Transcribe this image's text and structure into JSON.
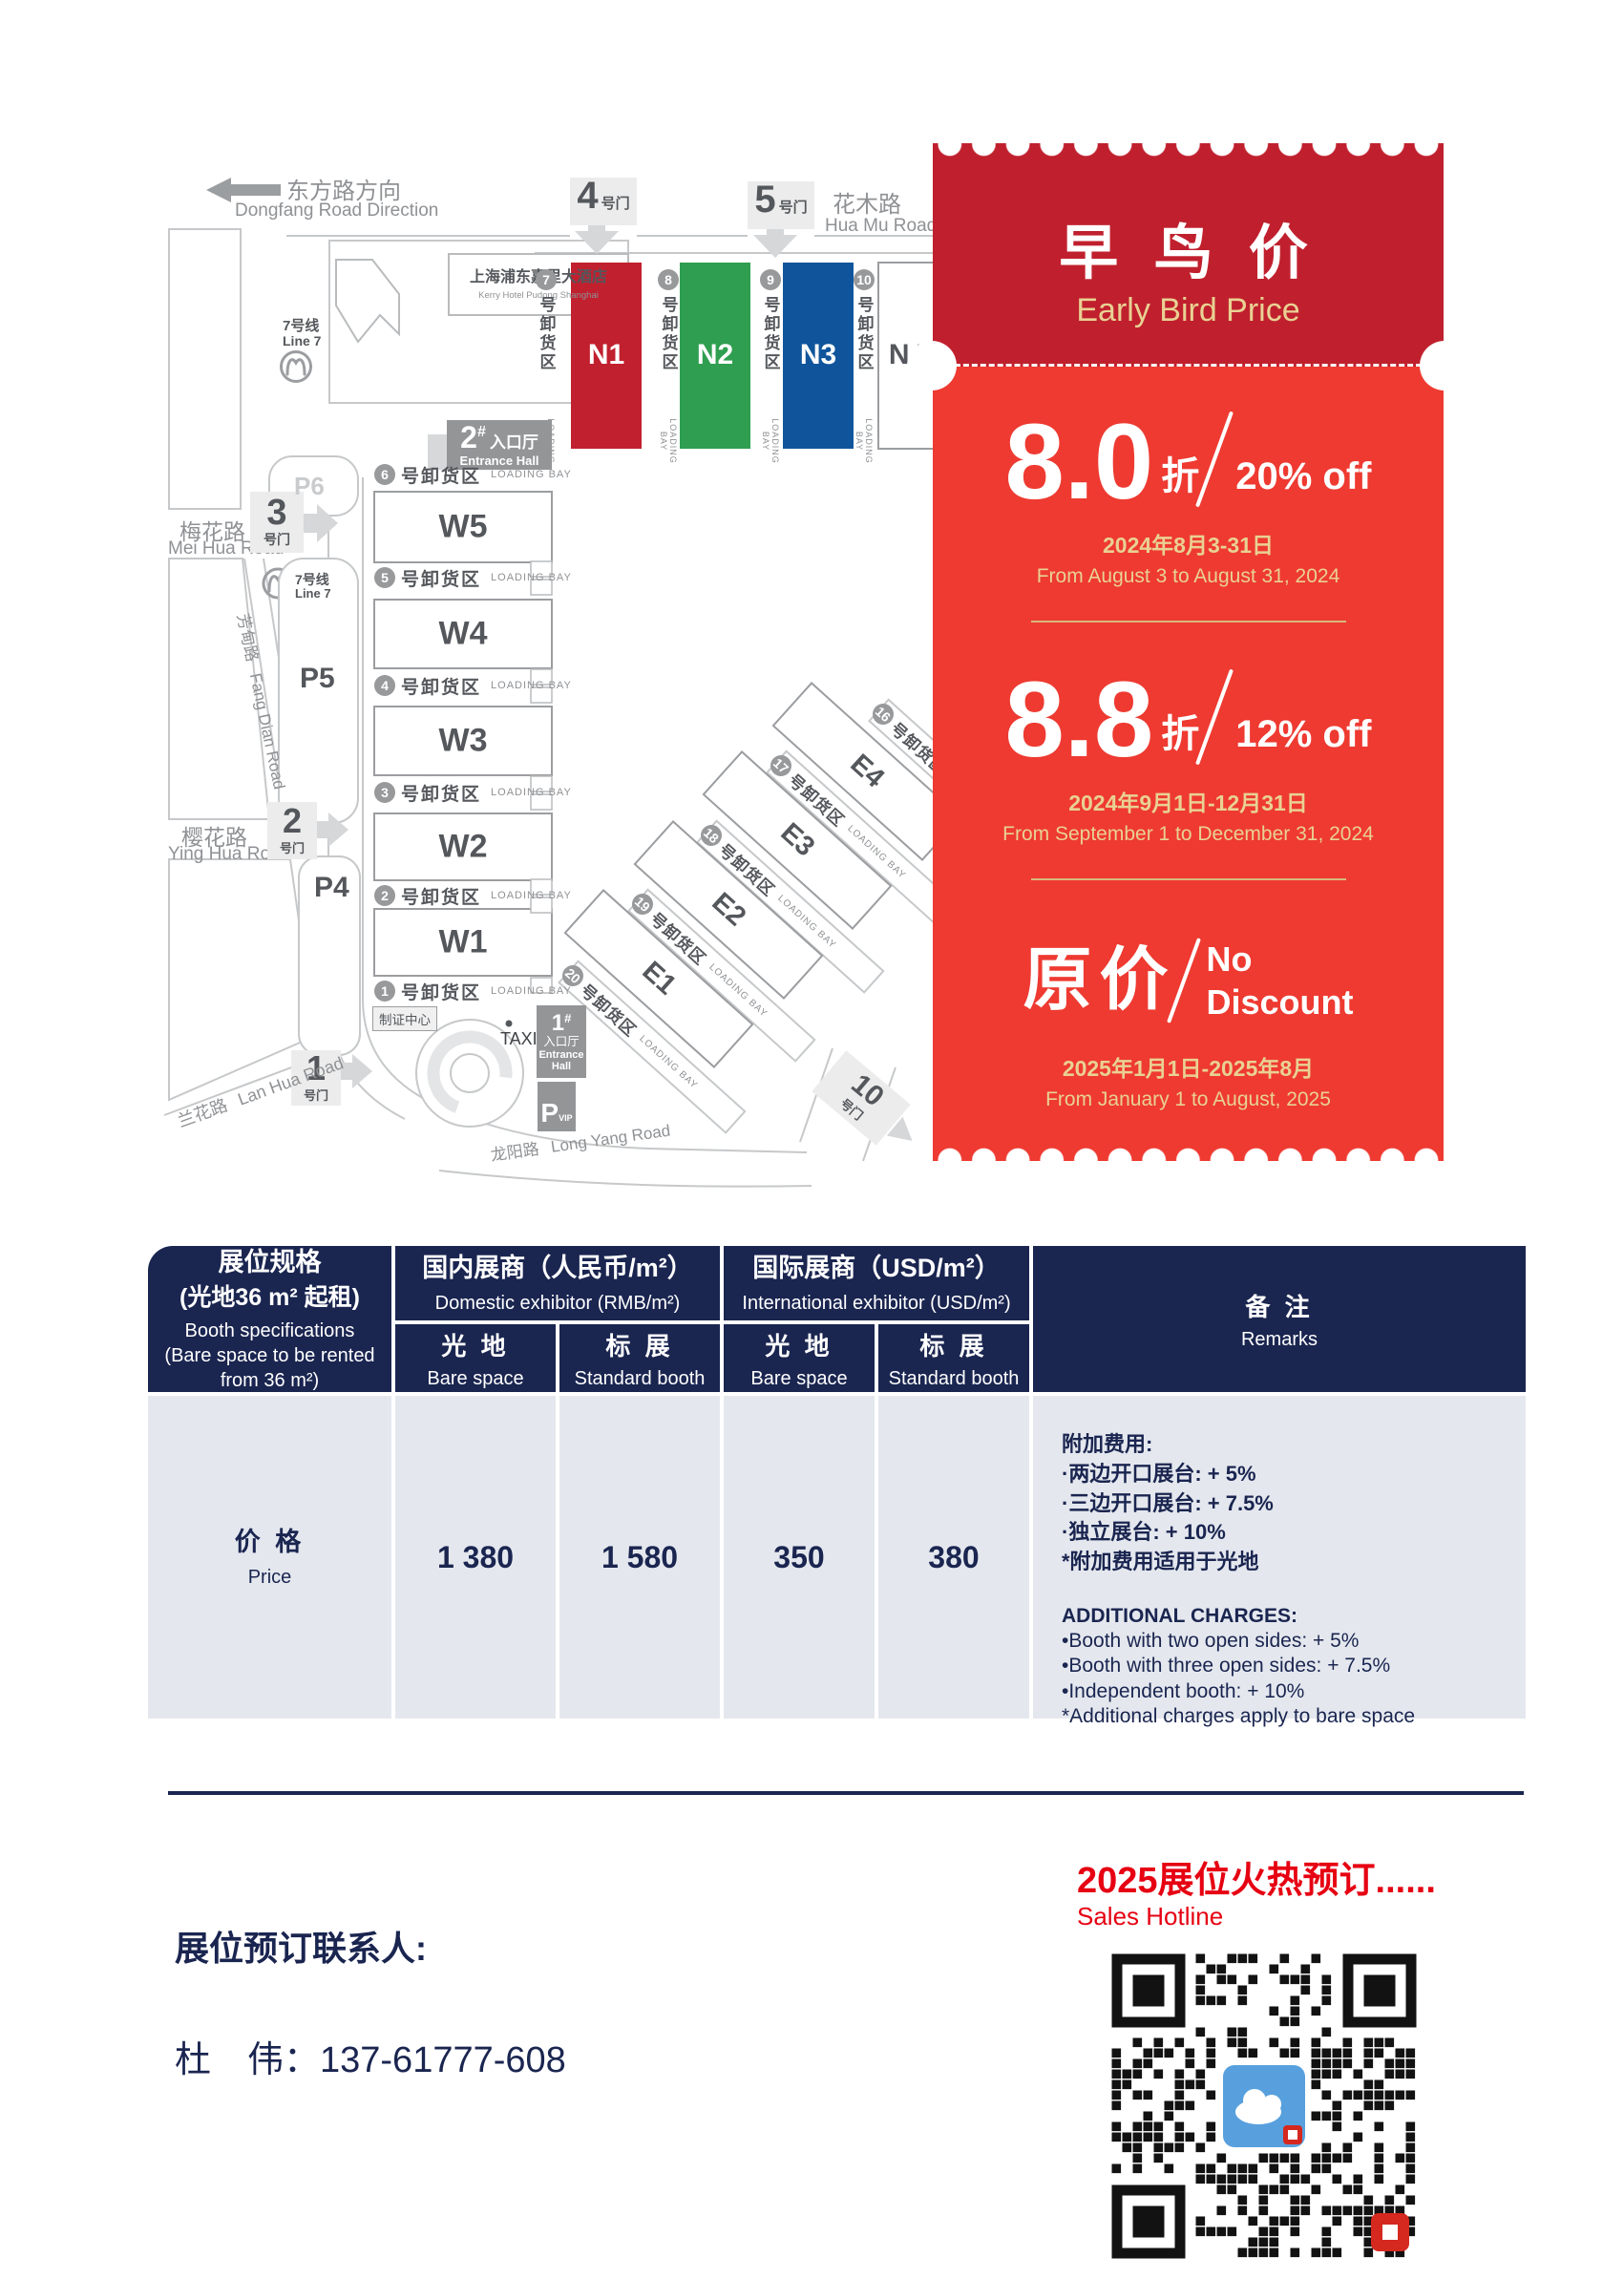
{
  "map": {
    "direction": {
      "zh": "东方路方向",
      "en": "Dongfang Road Direction"
    },
    "roads": {
      "huamu": {
        "zh": "花木路",
        "en": "Hua Mu Road"
      },
      "meihua": {
        "zh": "梅花路",
        "en": "Mei Hua Road"
      },
      "yinghua": {
        "zh": "樱花路",
        "en": "Ying Hua Road"
      },
      "fangdian": {
        "zh": "芳甸路",
        "en": "Fang Dian Road"
      },
      "lanhua": {
        "zh": "兰花路",
        "en": "Lan Hua Road"
      },
      "longyang": {
        "zh": "龙阳路",
        "en": "Long Yang Road"
      }
    },
    "metro": {
      "zh": "7号线",
      "en": "Line 7"
    },
    "hotel": {
      "zh": "上海浦东嘉里大酒店",
      "en": "Kerry Hotel Pudong Shanghai"
    },
    "gates": {
      "g1": "1",
      "g2": "2",
      "g3": "3",
      "g4": "4",
      "g5": "5",
      "g10": "10",
      "suffix": "号门"
    },
    "parking": {
      "p4": "P4",
      "p5": "P5",
      "p6": "P6",
      "vip_p": "P",
      "vip": "VIP"
    },
    "entrances": {
      "e1_num": "1",
      "e2_num": "2",
      "hash": "#",
      "hall_zh": "入口厅",
      "hall_en": "Entrance Hall",
      "hall_en1": "Entrance",
      "hall_en2": "Hall"
    },
    "badge_center": "制证中心",
    "taxi": "TAXI",
    "loading": {
      "zh": "号卸货区",
      "en": "LOADING BAY"
    },
    "halls_n": [
      {
        "id": "N1",
        "color": "#c1202f"
      },
      {
        "id": "N2",
        "color": "#2f9e50"
      },
      {
        "id": "N3",
        "color": "#10559c"
      },
      {
        "id": "N4",
        "color": "#ffffff"
      }
    ],
    "bays_n": [
      "7",
      "8",
      "9",
      "10"
    ],
    "halls_w": [
      "W5",
      "W4",
      "W3",
      "W2",
      "W1"
    ],
    "bays_w": [
      "6",
      "5",
      "4",
      "3",
      "2",
      "1"
    ],
    "halls_e": [
      "E4",
      "E3",
      "E2",
      "E1"
    ],
    "bays_e": [
      "16",
      "17",
      "18",
      "19",
      "20"
    ]
  },
  "coupon": {
    "title_zh": "早 鸟 价",
    "title_en": "Early Bird Price",
    "colors": {
      "header": "#c0202e",
      "body": "#ee3a31",
      "gold": "#e9d193"
    },
    "tiers": [
      {
        "big": "8.0",
        "zhe": "折",
        "pct": "20% off",
        "date_zh": "2024年8月3-31日",
        "date_en": "From August 3 to August 31, 2024"
      },
      {
        "big": "8.8",
        "zhe": "折",
        "pct": "12% off",
        "date_zh": "2024年9月1日-12月31日",
        "date_en": "From September 1 to December 31, 2024"
      }
    ],
    "original": {
      "zh": "原价",
      "en1": "No",
      "en2": "Discount",
      "date_zh": "2025年1月1日-2025年8月",
      "date_en": "From January 1 to August, 2025"
    }
  },
  "table": {
    "spec_title": "展位规格",
    "spec_sub": "(光地36 m² 起租)",
    "spec_en1": "Booth specifications",
    "spec_en2": "(Bare space to be rented",
    "spec_en3": "from 36 m²)",
    "domestic_zh": "国内展商（人民币/m²）",
    "domestic_en": "Domestic exhibitor (RMB/m²)",
    "intl_zh": "国际展商（USD/m²）",
    "intl_en": "International exhibitor (USD/m²)",
    "bare_zh": "光 地",
    "bare_en": "Bare space",
    "std_zh": "标 展",
    "std_en": "Standard booth",
    "remarks_zh": "备 注",
    "remarks_en": "Remarks",
    "price_zh": "价 格",
    "price_en": "Price",
    "values": [
      "1 380",
      "1 580",
      "350",
      "380"
    ],
    "remarks_cn": [
      "附加费用:",
      "·两边开口展台: + 5%",
      "·三边开口展台: + 7.5%",
      "·独立展台: + 10%",
      "*附加费用适用于光地"
    ],
    "remarks_en_lines": [
      "ADDITIONAL CHARGES:",
      "•Booth with two open sides: + 5%",
      "•Booth with three open sides: + 7.5%",
      "•Independent booth: + 10%",
      "*Additional charges apply to bare space"
    ]
  },
  "footer": {
    "hotline_zh": "2025展位火热预订......",
    "hotline_en": "Sales Hotline",
    "contact_label": "展位预订联系人:",
    "contact": "杜　伟：137-61777-608"
  }
}
